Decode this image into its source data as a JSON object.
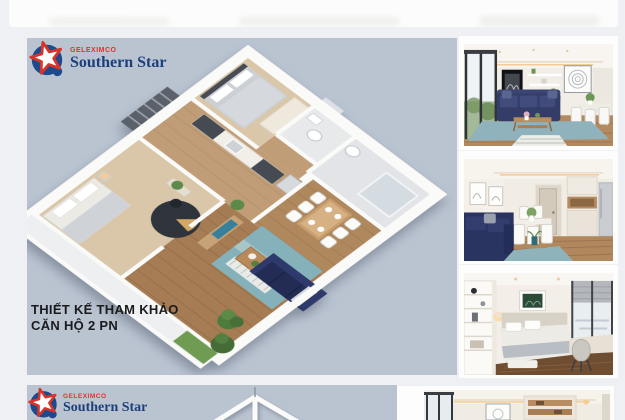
{
  "page": {
    "background_color": "#eff0f3"
  },
  "previous_image_strip": {
    "background_color": "#fcfcfc",
    "note_name": "bottom-edge-of-previous-gallery-image"
  },
  "brand": {
    "company": "GELEXIMCO",
    "project": "Southern Star",
    "company_color": "#e2322a",
    "project_color": "#1d3f7b",
    "star_red": "#d7342a",
    "star_blue": "#1d4a8c"
  },
  "main_card": {
    "background_color": "#bac4d1",
    "caption_line1": "THIẾT KẾ THAM KHẢO",
    "caption_line2": "CĂN HỘ 2 PN",
    "floorplan": {
      "kind": "3d-isometric-apartment-floorplan",
      "bedrooms": 2,
      "rooms": [
        "bedroom-2",
        "bathroom-1",
        "bathroom-2",
        "kitchen",
        "dining-area",
        "master-bedroom",
        "living-room",
        "balcony"
      ],
      "floor_wood_color": "#a57c54",
      "wall_color": "#fafaf9",
      "sofa_color": "#232c55",
      "rug_color": "#85b1ba"
    }
  },
  "photo_column": {
    "photos": [
      {
        "name": "living-room-photo-1",
        "subject": "living room with navy sofa, blue rug, wooden coffee table, white dining set, mandala wall art"
      },
      {
        "name": "living-room-photo-2",
        "subject": "living room toward hallway with navy sofa, white dining chairs, wooden floor, cabinets and fridge"
      },
      {
        "name": "bedroom-photo-3",
        "subject": "bedroom with white shelving, bed, botanical art, roman blind window, desk and chair"
      }
    ]
  },
  "bottom_card": {
    "background_color": "#bac4d1",
    "note_name": "top-edge-of-next-floorplan-image"
  },
  "bottom_photo": {
    "name": "living-room-photo-4",
    "subject": "top strip of interior photo with cove-lit ceiling, window, framed art, wooden cabinet"
  }
}
